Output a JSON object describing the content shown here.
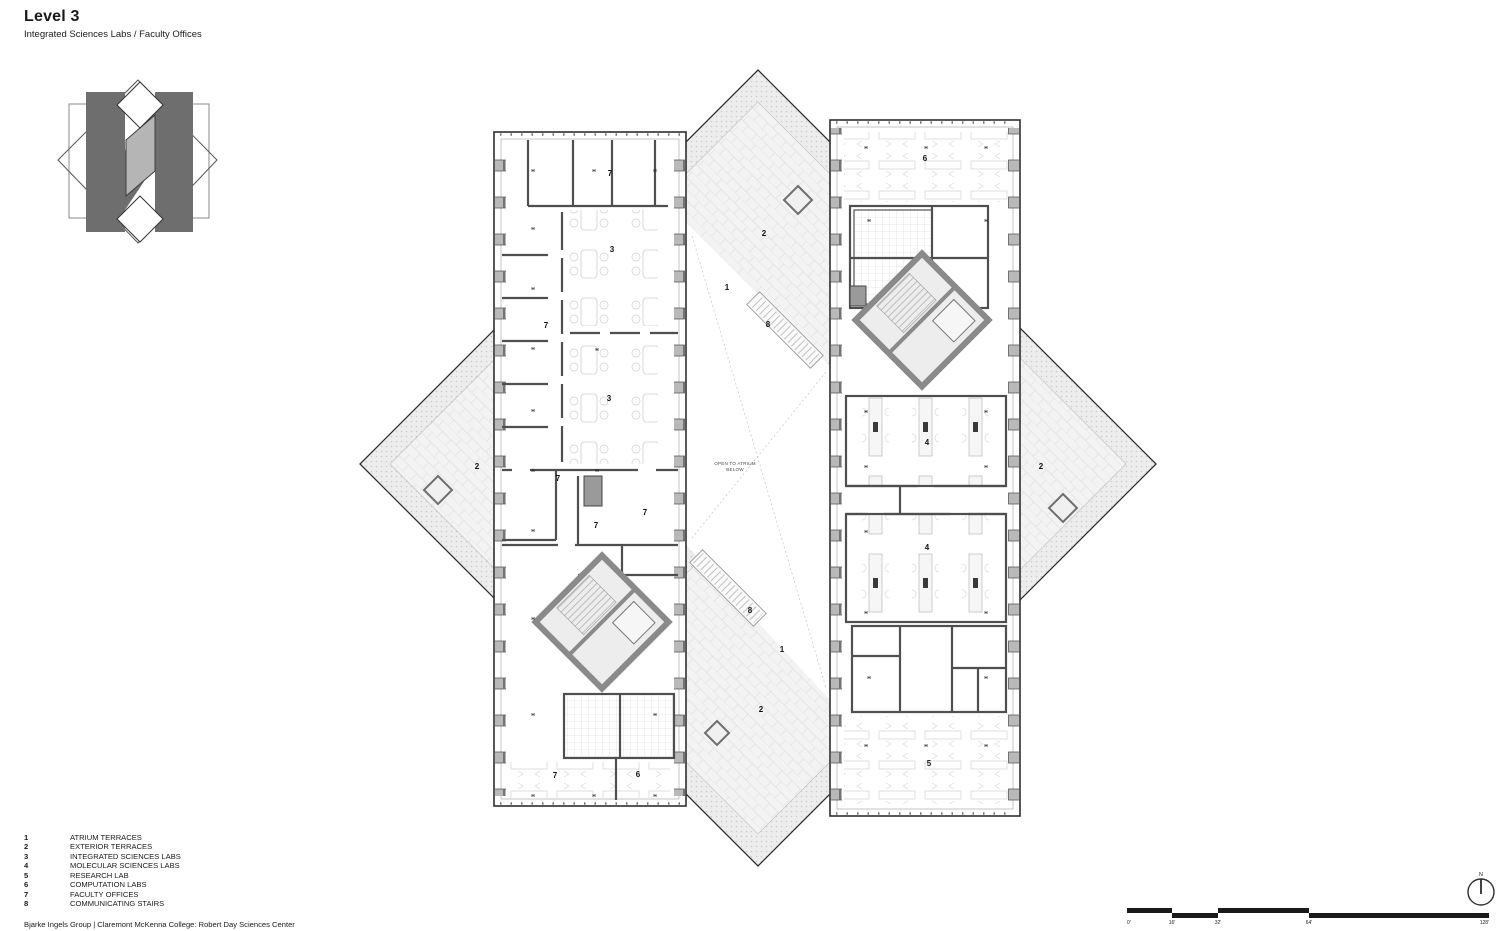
{
  "header": {
    "title": "Level 3",
    "subtitle": "Integrated Sciences Labs / Faculty Offices"
  },
  "legend": {
    "items": [
      {
        "num": "1",
        "label": "ATRIUM TERRACES"
      },
      {
        "num": "2",
        "label": "EXTERIOR TERRACES"
      },
      {
        "num": "3",
        "label": "INTEGRATED SCIENCES LABS"
      },
      {
        "num": "4",
        "label": "MOLECULAR SCIENCES LABS"
      },
      {
        "num": "5",
        "label": "RESEARCH LAB"
      },
      {
        "num": "6",
        "label": "COMPUTATION LABS"
      },
      {
        "num": "7",
        "label": "FACULTY OFFICES"
      },
      {
        "num": "8",
        "label": "COMMUNICATING STAIRS"
      }
    ]
  },
  "footer": {
    "credit": "Bjarke Ingels Group | Claremont McKenna College: Robert Day Sciences Center"
  },
  "scale_bar": {
    "ticks": [
      "0'",
      "16'",
      "32'",
      "64'",
      "128'"
    ]
  },
  "north_arrow": {
    "label": "N"
  },
  "plan": {
    "atrium_note_line1": "OPEN TO ATRIUM",
    "atrium_note_line2": "BELOW",
    "door_tag": "H",
    "labels": [
      {
        "text": "7"
      },
      {
        "text": "3"
      },
      {
        "text": "7"
      },
      {
        "text": "3"
      },
      {
        "text": "7"
      },
      {
        "text": "7"
      },
      {
        "text": "7"
      },
      {
        "text": "7"
      },
      {
        "text": "6"
      },
      {
        "text": "6"
      },
      {
        "text": "4"
      },
      {
        "text": "4"
      },
      {
        "text": "5"
      },
      {
        "text": "2"
      },
      {
        "text": "1"
      },
      {
        "text": "8"
      },
      {
        "text": "8"
      },
      {
        "text": "1"
      },
      {
        "text": "2"
      },
      {
        "text": "2"
      },
      {
        "text": "2"
      }
    ]
  },
  "colors": {
    "wall": "#4f4f4f",
    "outer_wall": "#2e2e2e",
    "column": "#b9b9b9",
    "core": "#8a8a8a",
    "core_floor": "#ededed",
    "paving": "#f3f3f3",
    "hatch": "#ededed",
    "logo_dark": "#6e6e6e",
    "logo_mid": "#b5b5b5"
  }
}
